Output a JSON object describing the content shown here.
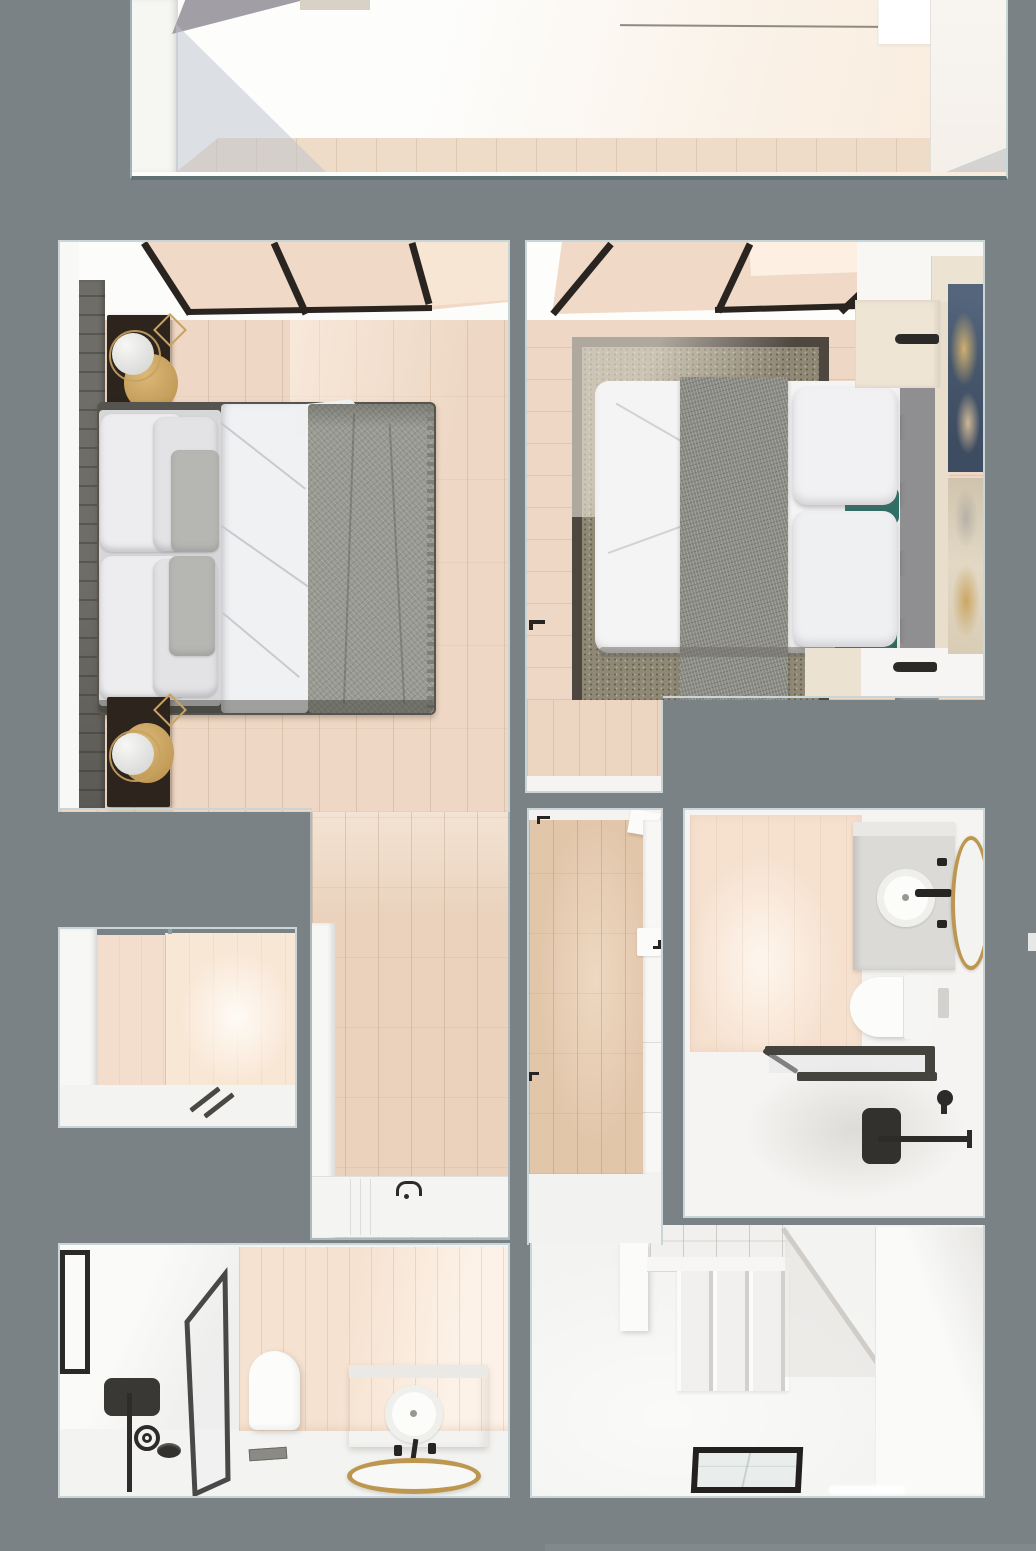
{
  "canvas": {
    "width": 1036,
    "height": 1551,
    "view": "top-down dollhouse 3D render of an apartment floor plan",
    "no_visible_text": true
  },
  "palette": {
    "wall_gray": "#7b8285",
    "outline": "#c8d6d7",
    "outline_dark": "#5f7173",
    "white_wall": "#f7f7f5",
    "white_floor": "#f3f3f1",
    "cream": "#f8ebdc",
    "wood_bedroom": "#eed8c5",
    "wood_hall": "#ead2bc",
    "wood_corridor": "#e2c6aa",
    "plank_line": "rgba(174,140,110,0.28)",
    "glass_peach": "#f0d9c6",
    "glass_peach_light": "#f8e6d5",
    "mullion_black": "#2a2420",
    "headboard_wall": "#6f6d67",
    "nightstand_dark": "#2d241d",
    "brass": "#c7a261",
    "lamp_white": "#ececea",
    "duvet_white": "#f0f1f3",
    "pillow_white": "#ededef",
    "pillow_gray": "#b6b6b2",
    "blanket_gray": "#989991",
    "bed_frame": "#56544f",
    "rug_border": "#4d4740",
    "rug_field": "#8f8874",
    "runner_gray": "#8a8b83",
    "teal_pillow": "#2e6f66",
    "headboard_gray": "#8f8f91",
    "mattress_white": "#f4f4f5",
    "art_navy": "#46566b",
    "art_gold": "#c9a362",
    "art_cream": "#d8ccb5",
    "wood_counter": "#efe5d5",
    "tile_peach": "#f6e1cf",
    "panel_peach": "#f6e2d0",
    "fixture_black": "#2c2b29",
    "frame_dark": "#4a4846",
    "shower_frame": "#45433e",
    "gold": "#bd9750",
    "vanity_gray": "#dbdad7",
    "porcelain": "#fcfcfb",
    "stair_seam": "#d2d0cc",
    "hatch_frame": "#22211f",
    "hatch_glass": "#e9edec"
  },
  "scene": {
    "type": "architectural-3d-floor-plan",
    "rooms": [
      {
        "id": "top-room",
        "label": "upper room (partially cropped)",
        "features": [
          "white walls",
          "diagonal sunlight",
          "pale wood floor strip",
          "corner shadow"
        ]
      },
      {
        "id": "bedroom-left",
        "label": "bedroom 1",
        "features": [
          "black-framed skylight with peach glass",
          "dark slatted headboard wall",
          "two dark nightstands with sphere lamps on brass discs",
          "double bed: white pillows, gray accent pillows, white duvet, textured gray blanket with fringe",
          "pale wood plank floor"
        ]
      },
      {
        "id": "bedroom-right",
        "label": "bedroom 2",
        "features": [
          "black-framed skylight with peach glass",
          "speckled area rug with dark border",
          "bed with gray scalloped headboard",
          "white pillows and teal accent cushions",
          "textured gray runner across bed",
          "light wood side counters with black wall sconces",
          "two abstract artworks (navy/gold and cream/gold) on right wall"
        ]
      },
      {
        "id": "hall",
        "label": "hallway with bathtub",
        "features": [
          "wood floor",
          "white ledge wall",
          "bathtub with black faucet at bottom"
        ]
      },
      {
        "id": "corridor",
        "label": "central corridor",
        "features": [
          "wood floor",
          "white closet doors with black handles",
          "door leaf at top"
        ]
      },
      {
        "id": "bathroom-right",
        "label": "bathroom 1",
        "features": [
          "peach tiled wall",
          "vanity with round vessel sink and black faucet",
          "gold oval mirror",
          "wall-hung toilet with flush plate",
          "black-framed shower screen",
          "black shower shelf, hand shower and towel bar"
        ]
      },
      {
        "id": "small-room",
        "label": "walk-in shower room",
        "features": [
          "peach tiled walls",
          "white floor",
          "dark linear drain"
        ]
      },
      {
        "id": "bathroom-bl",
        "label": "bathroom 2",
        "features": [
          "black-framed window",
          "black-framed glass shower screen",
          "black shower column and drain",
          "wall-hung toilet",
          "peach wood-paneled wall",
          "gray vanity with round sink and black taps",
          "round gold mirror",
          "floor drain"
        ]
      },
      {
        "id": "bottom-room",
        "label": "stair hall",
        "features": [
          "white staircase with winder treads",
          "diagonal stringer shadow",
          "black-framed glass floor hatch"
        ]
      }
    ]
  }
}
